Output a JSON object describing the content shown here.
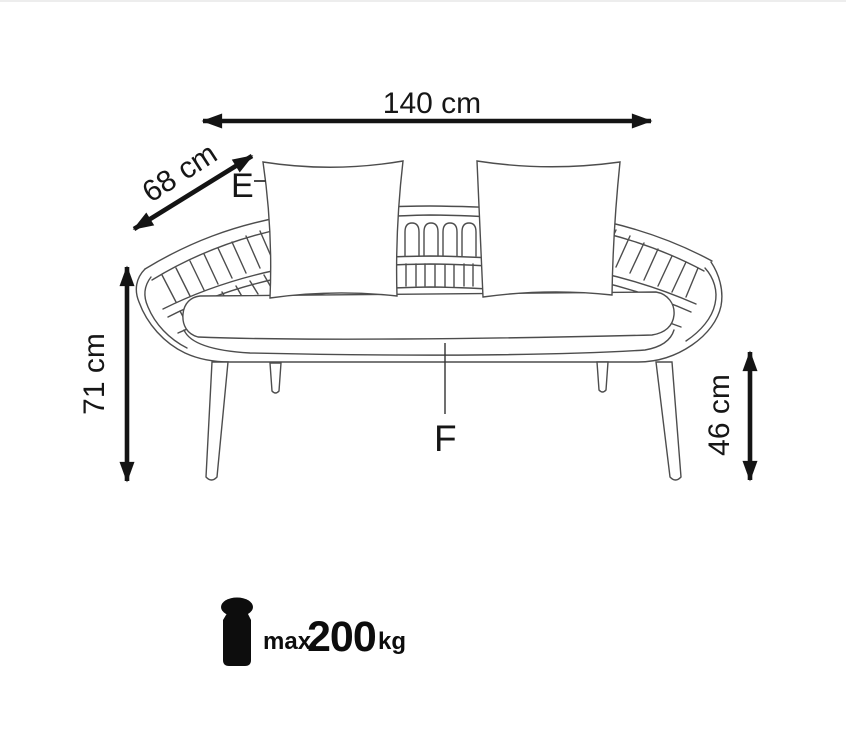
{
  "canvas": {
    "width": 846,
    "height": 756,
    "background": "#ffffff"
  },
  "colors": {
    "drawing_line": "#4d4d4d",
    "dimension_line": "#141414",
    "text": "#161616"
  },
  "diagram": {
    "subject": "outdoor bench / sofa technical line drawing with dimensions",
    "dimensions": {
      "width": {
        "label": "140 cm",
        "orientation": "horizontal"
      },
      "depth": {
        "label": "68 cm",
        "orientation": "diagonal"
      },
      "height": {
        "label": "71 cm",
        "orientation": "vertical"
      },
      "seat_height": {
        "label": "46 cm",
        "orientation": "vertical"
      }
    },
    "part_labels": {
      "pillow": {
        "label": "E"
      },
      "seat": {
        "label": "F"
      }
    },
    "max_load": {
      "prefix": "max.",
      "value": "200",
      "unit": "kg"
    }
  }
}
